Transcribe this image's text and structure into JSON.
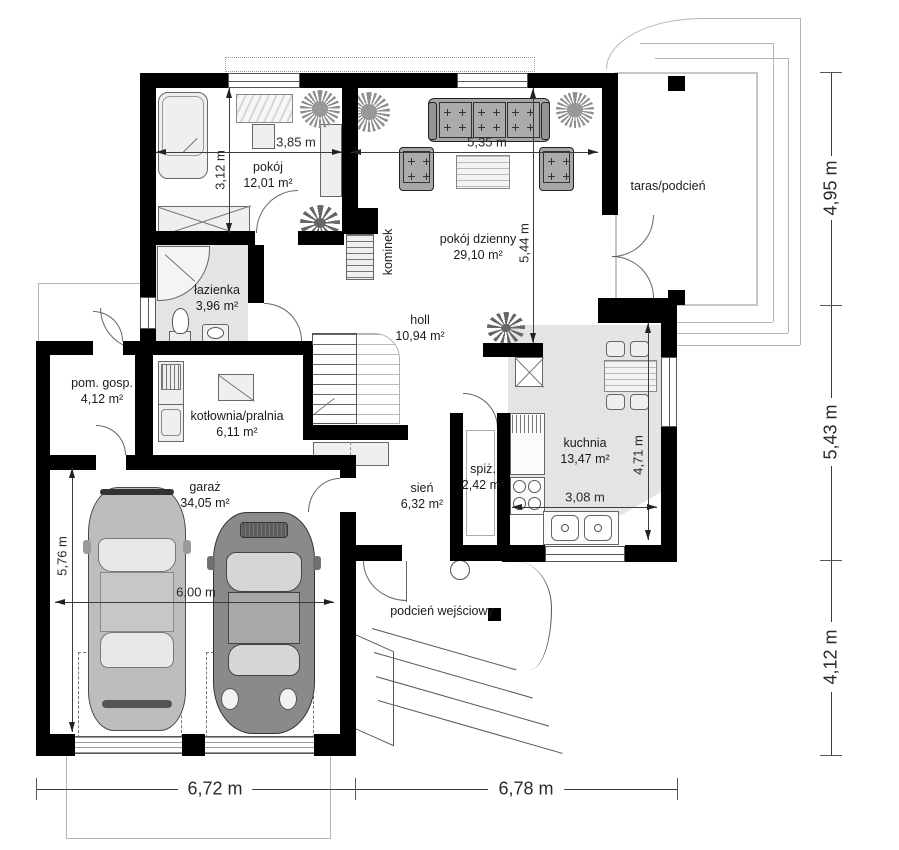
{
  "rooms": {
    "pokoj": {
      "name": "pokój",
      "area": "12,01 m²"
    },
    "pokoj_dzienny": {
      "name": "pokój dzienny",
      "area": "29,10 m²"
    },
    "taras": {
      "name": "taras/podcień"
    },
    "lazienka": {
      "name": "łazienka",
      "area": "3,96 m²"
    },
    "holl": {
      "name": "holl",
      "area": "10,94 m²"
    },
    "pom_gosp": {
      "name": "pom. gosp.",
      "area": "4,12 m²"
    },
    "kotlownia": {
      "name": "kotłownia/pralnia",
      "area": "6,11 m²"
    },
    "garaz": {
      "name": "garaż",
      "area": "34,05 m²"
    },
    "sien": {
      "name": "sień",
      "area": "6,32 m²"
    },
    "spiz": {
      "name": "spiż.",
      "area": "2,42 m²"
    },
    "kuchnia": {
      "name": "kuchnia",
      "area": "13,47 m²"
    },
    "podcien_wejsciowy": {
      "name": "podcień wejściowy"
    },
    "kominek": {
      "name": "kominek"
    }
  },
  "dims": {
    "d385": "3,85 m",
    "d312": "3,12 m",
    "d535": "5,35 m",
    "d544": "5,44 m",
    "d471": "4,71 m",
    "d308": "3,08 m",
    "d600": "6,00 m",
    "d576": "5,76 m",
    "d495": "4,95 m",
    "d543": "5,43 m",
    "d412": "4,12 m",
    "d672": "6,72 m",
    "d678": "6,78 m"
  },
  "colors": {
    "wall": "#000000",
    "room_fill": "#e4e4e4",
    "furniture_fill": "#efefef",
    "car_light": "#bdbdbd",
    "car_dark": "#8a8a8a",
    "dim_line": "#3c3c3c"
  }
}
